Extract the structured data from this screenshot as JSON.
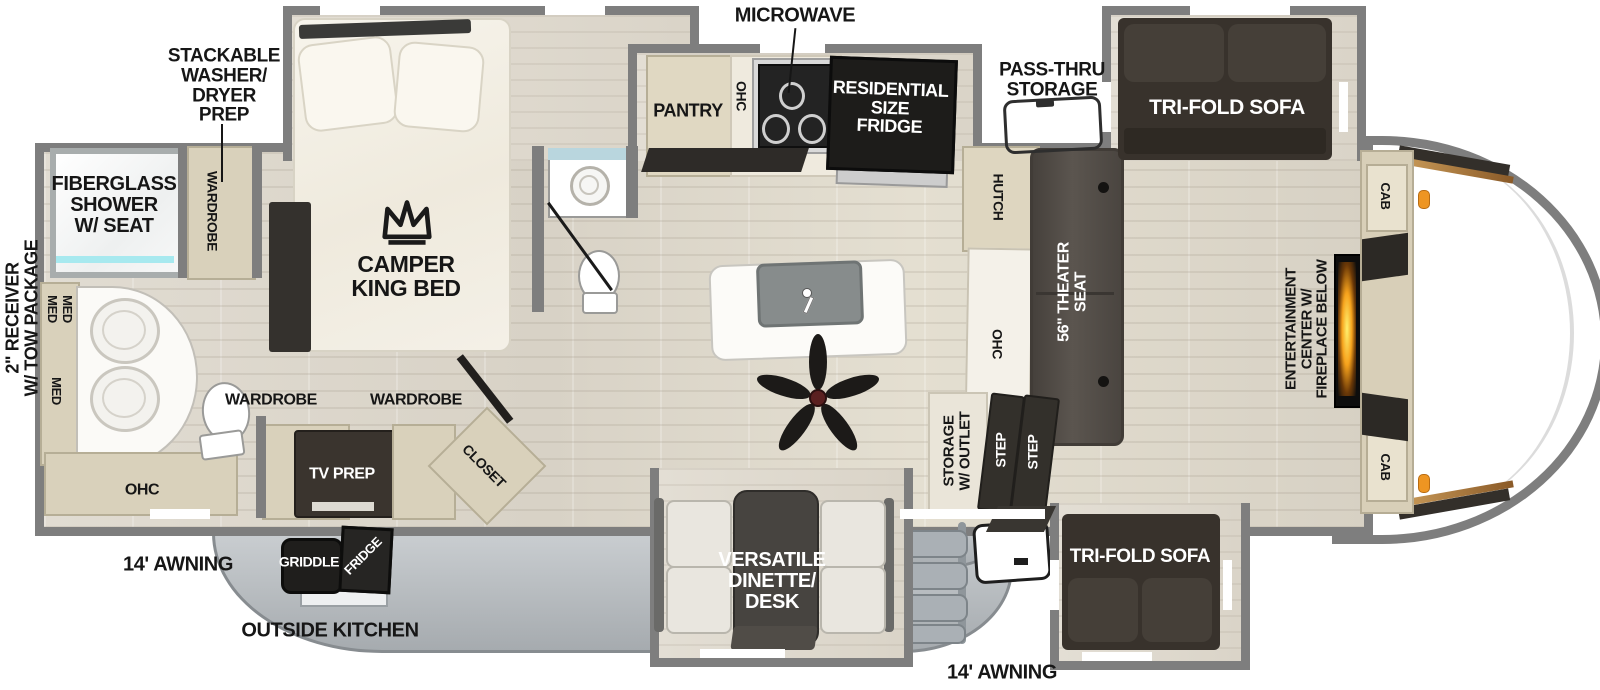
{
  "title": "Fifth Wheel RV Floorplan",
  "labels": {
    "microwave": "MICROWAVE",
    "pass_thru_storage": "PASS-THRU\nSTORAGE",
    "washer_dryer_prep": "STACKABLE\nWASHER/\nDRYER\nPREP",
    "fiberglass_shower": "FIBERGLASS\nSHOWER\nW/ SEAT",
    "camper_king_bed": "CAMPER\nKING BED",
    "wardrobe": "WARDROBE",
    "med": "MED",
    "ohc": "OHC",
    "pantry": "PANTRY",
    "residential_fridge": "RESIDENTIAL\nSIZE\nFRIDGE",
    "hutch": "HUTCH",
    "theater_seat": "56\" THEATER\nSEAT",
    "trifold_sofa": "TRI-FOLD SOFA",
    "cab": "CAB",
    "entertainment_center": "ENTERTAINMENT\nCENTER W/\nFIREPLACE BELOW",
    "storage_outlet": "STORAGE\nW/ OUTLET",
    "step": "STEP",
    "tv_prep": "TV PREP",
    "closet": "CLOSET",
    "griddle": "GRIDDLE",
    "fridge_outside": "FRIDGE",
    "outside_kitchen": "OUTSIDE KITCHEN",
    "awning": "14' AWNING",
    "versatile_dinette": "VERSATILE\nDINETTE/\nDESK",
    "receiver_tow": "2\" RECEIVER\nW/ TOW PACKAGE"
  },
  "colors": {
    "wall_gray": "#7e7e7e",
    "cabinet_tan": "#d9d1bb",
    "dark_furniture": "#38322c",
    "skirt_gray": "#b9bec2",
    "flame_orange": "#f6a21c",
    "shower_glass": "#a7e9ef",
    "handle_orange": "#ee9522"
  }
}
